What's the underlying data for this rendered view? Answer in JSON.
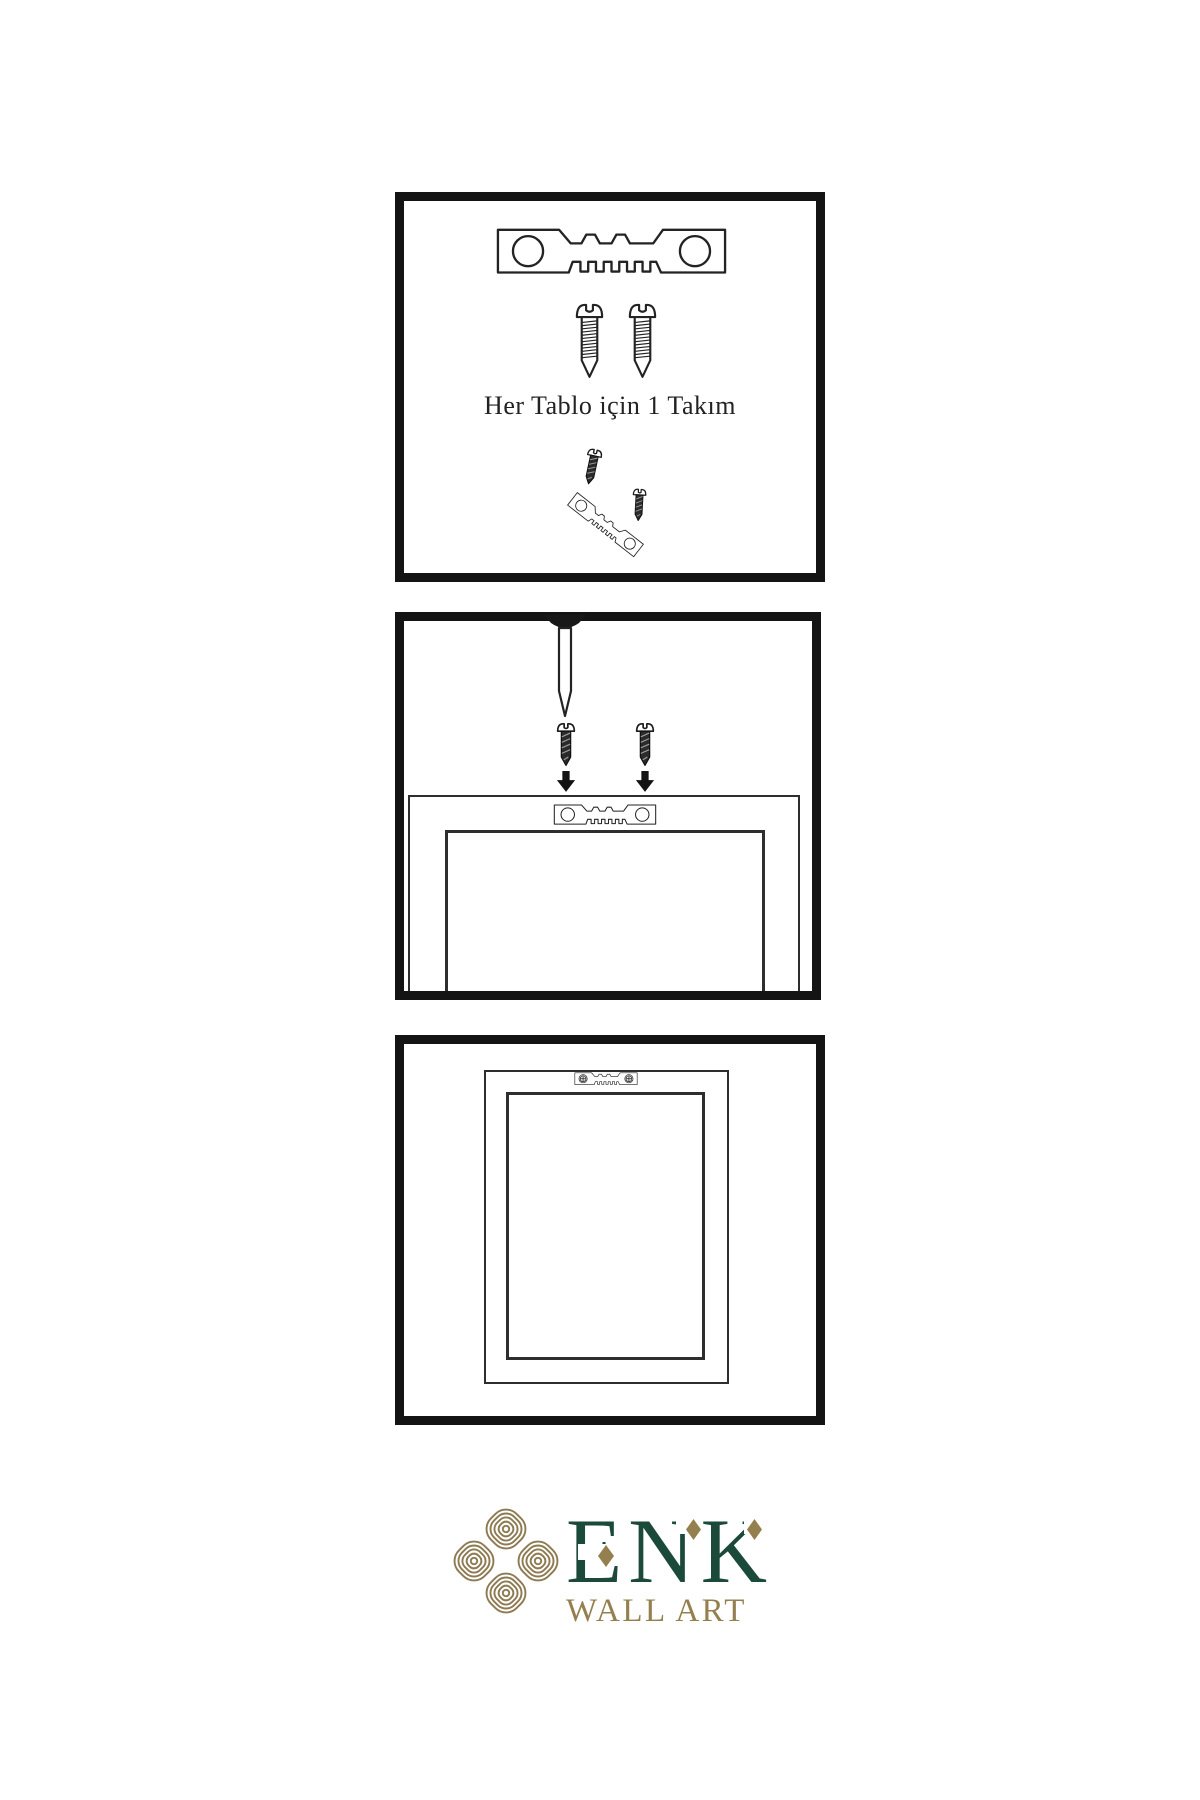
{
  "page": {
    "background_color": "#ffffff"
  },
  "panels": {
    "step1": {
      "name": "hardware-kit",
      "caption": "Her Tablo için 1 Takım",
      "icons": [
        "sawtooth-hanger-icon",
        "screw-icon",
        "screw-icon",
        "screw-into-hanger-icon"
      ]
    },
    "step2": {
      "name": "attach-hanger-and-nail",
      "icons": [
        "nail-icon",
        "dark-screw-icon",
        "dark-screw-icon",
        "down-arrow-icon",
        "down-arrow-icon",
        "frame-back-icon",
        "sawtooth-hanger-icon"
      ]
    },
    "step3": {
      "name": "hanger-mounted-on-frame-back",
      "icons": [
        "frame-back-icon",
        "mounted-sawtooth-hanger-icon"
      ]
    }
  },
  "logo": {
    "icon": "knot-icon",
    "brand": "ENK",
    "subtitle": "WALL ART",
    "colors": {
      "green": "#1b4a3b",
      "gold": "#94804f"
    }
  }
}
